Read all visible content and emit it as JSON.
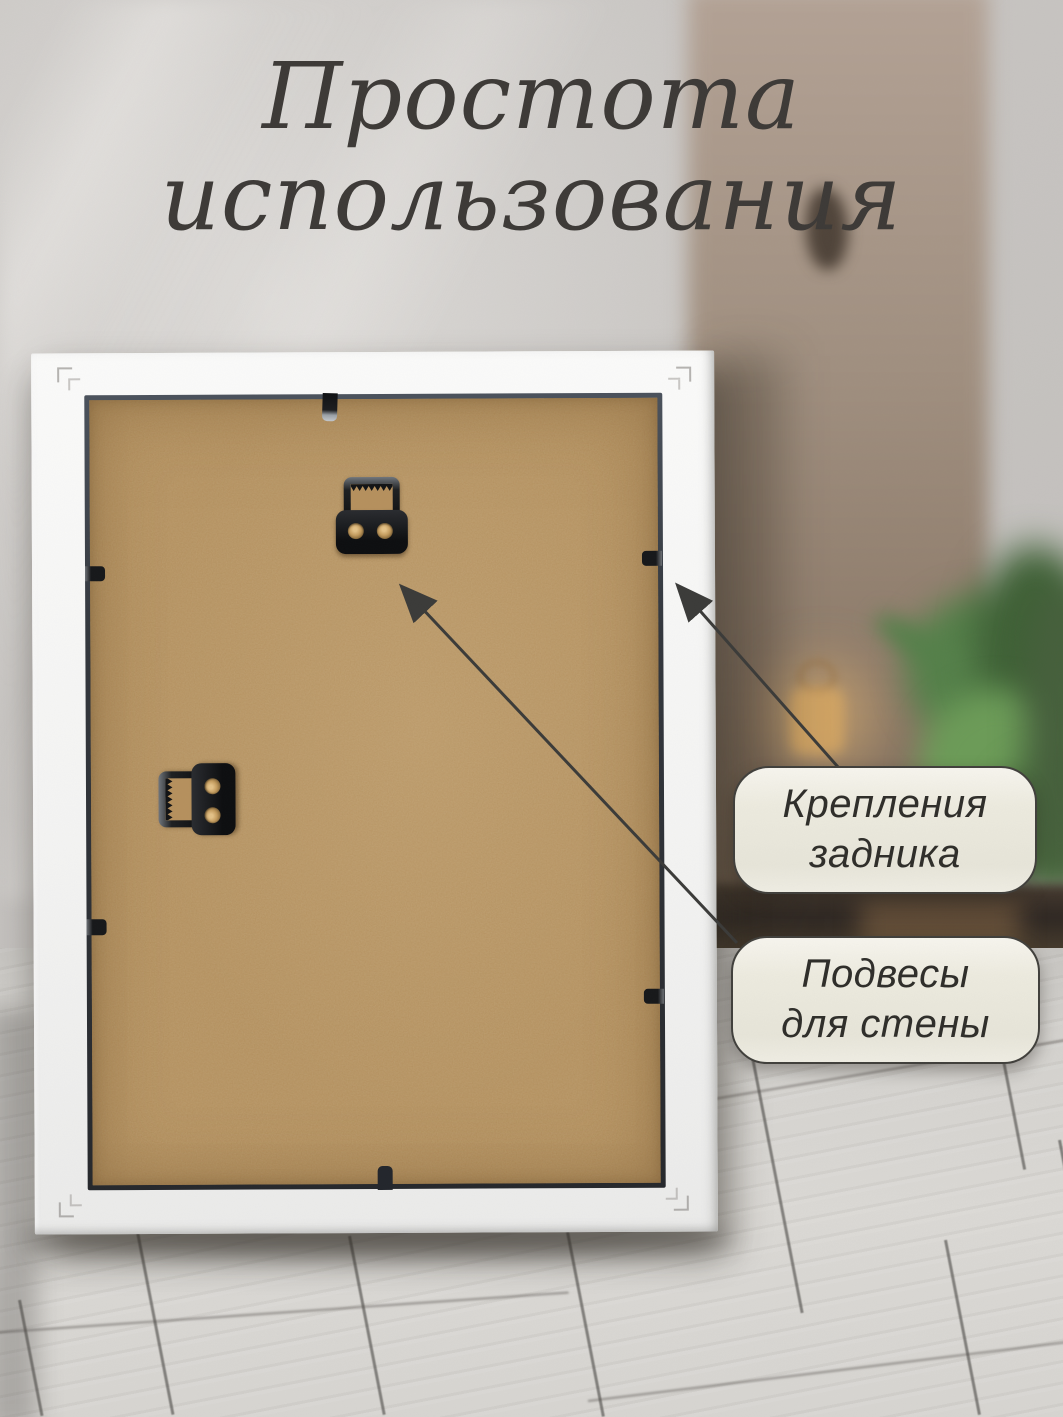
{
  "title": {
    "line1": "Простота",
    "line2": "использования"
  },
  "callouts": {
    "backing_fasteners": {
      "line1": "Крепления",
      "line2": "задника"
    },
    "wall_hangers": {
      "line1": "Подвесы",
      "line2": "для стены"
    }
  },
  "scene_objects": {
    "frame": "white-picture-frame-back",
    "backing": "mdf-backing-board",
    "hangers": [
      "sawtooth-hanger-top",
      "sawtooth-hanger-side"
    ],
    "clips": [
      "top",
      "left-upper",
      "left-lower",
      "right-upper",
      "right-lower",
      "bottom"
    ]
  },
  "colors": {
    "title_text": "#3d3a37",
    "callout_fill": "#eceade",
    "callout_border": "#41403c",
    "callout_text": "#2f2e2a",
    "arrow": "#3b3b39",
    "frame_white": "#f4f4f3",
    "backing_tan": "#b28d5a",
    "hardware_black": "#17181a",
    "wall_gray": "#c7c4c1",
    "floor_gray": "#d8d6d2",
    "plant_green": "#55814a"
  }
}
